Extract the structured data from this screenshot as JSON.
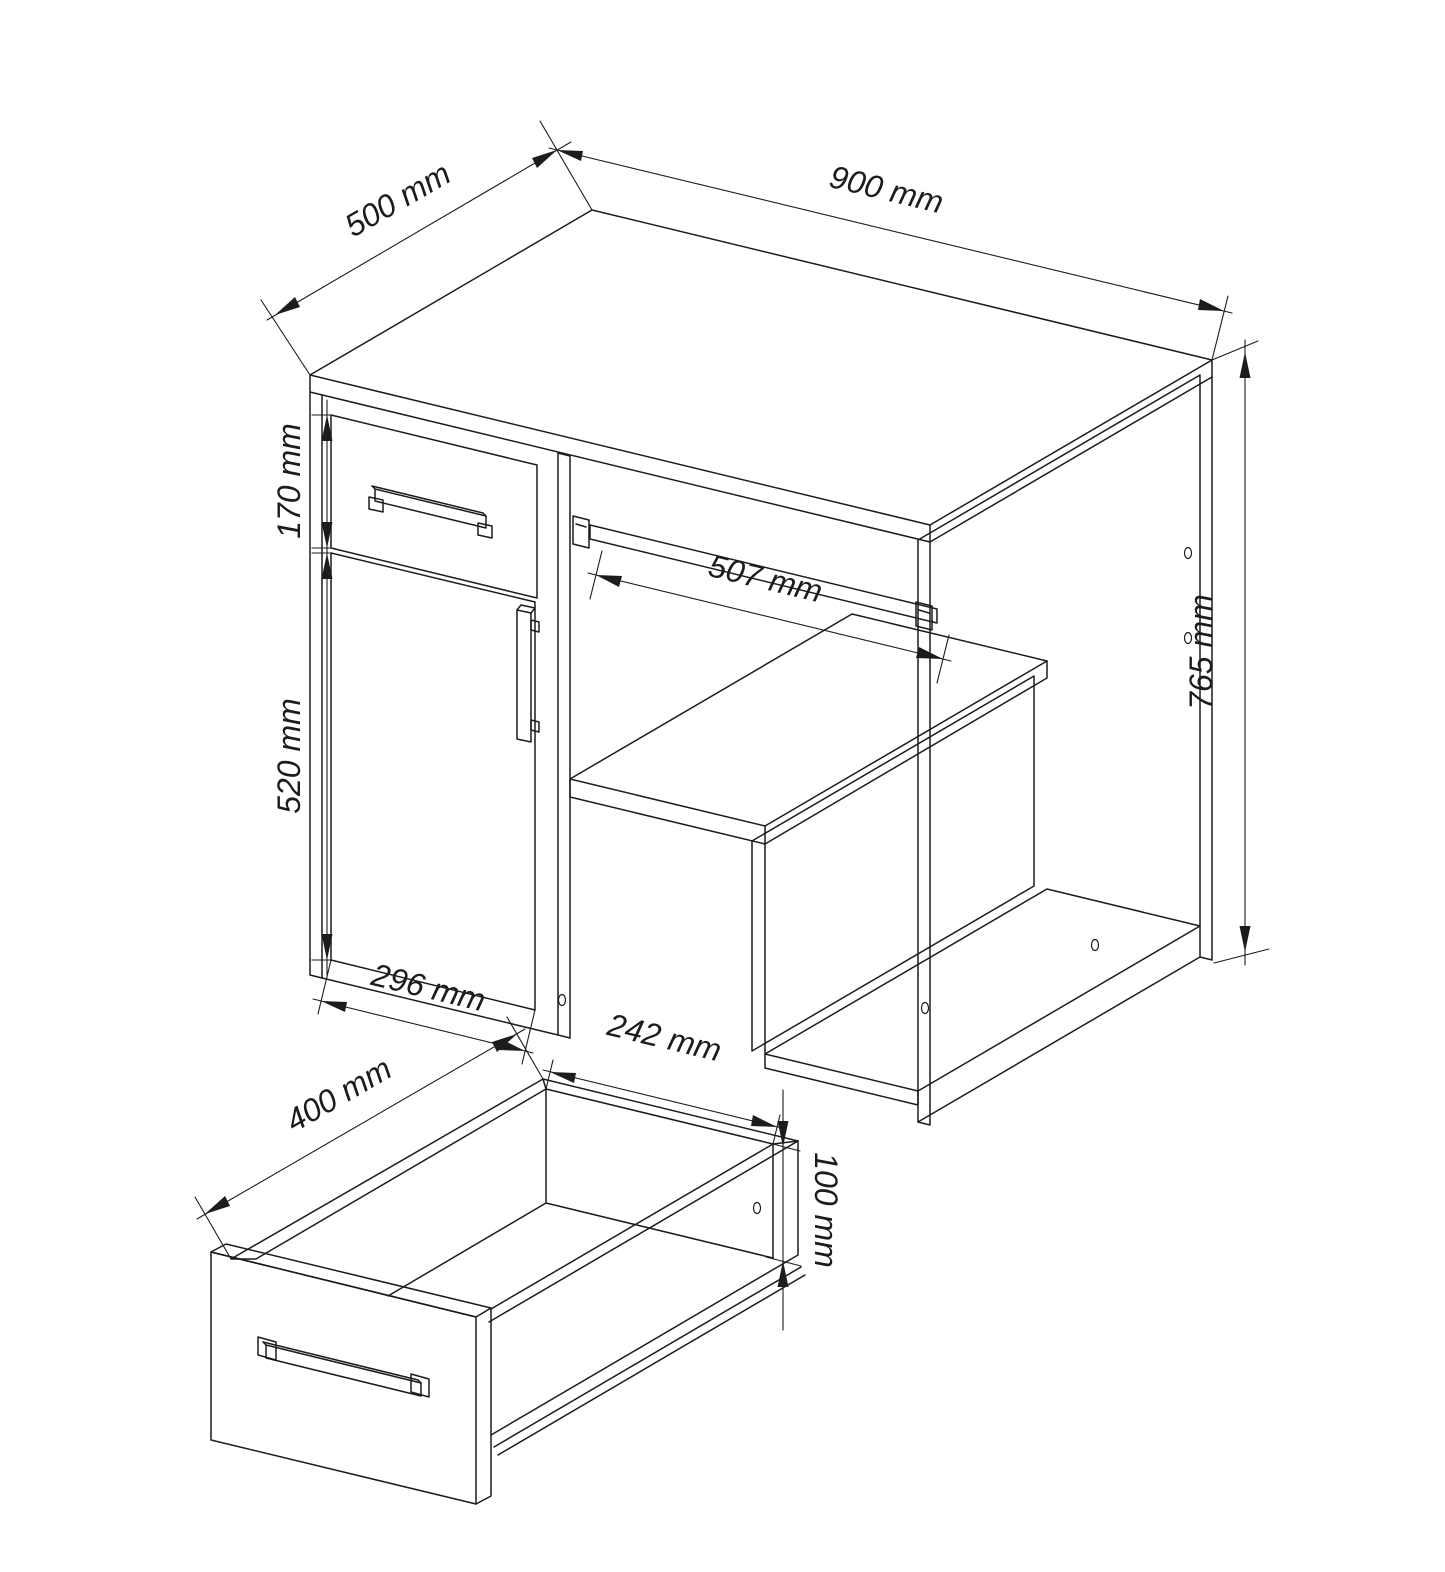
{
  "drawing": {
    "kind": "furniture technical line drawing",
    "subject": "computer desk with drawer, cabinet door, keyboard shelf and open drawer detail",
    "line_color": "#1c1c1c",
    "background_color": "#ffffff",
    "unit": "mm",
    "desk": {
      "dims": {
        "depth": "500 mm",
        "width": "900 mm",
        "drawer_front_height": "170 mm",
        "door_height": "520 mm",
        "door_width": "296 mm",
        "keyboard_tray_width": "507 mm",
        "total_height": "765 mm"
      }
    },
    "drawer_detail": {
      "dims": {
        "depth": "400 mm",
        "inner_width": "242 mm",
        "inner_height": "100 mm"
      }
    }
  }
}
